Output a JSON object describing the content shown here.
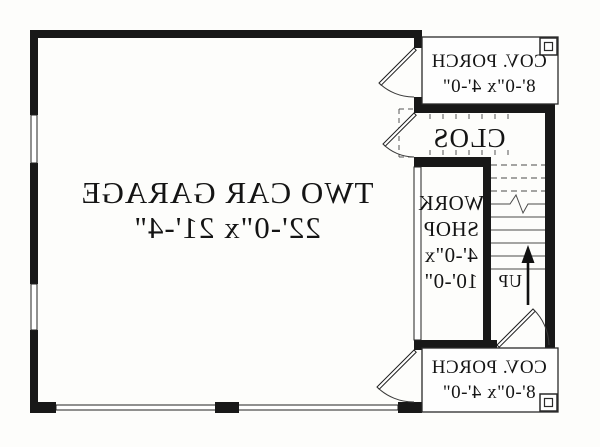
{
  "plan": {
    "garage": {
      "name": "TWO CAR GARAGE",
      "dims": "22'-0\"x 21'-4\""
    },
    "workshop": {
      "name_line1": "WORK",
      "name_line2": "SHOP",
      "dims_line1": "4'-0\"x",
      "dims_line2": "10'-0\""
    },
    "closet": {
      "name": "CLOS"
    },
    "porch_top": {
      "name": "COV. PORCH",
      "dims": "8'-0\"x 4'-0\""
    },
    "porch_bottom": {
      "name": "COV. PORCH",
      "dims": "8'-0\"x 4'-0\""
    },
    "stairs": {
      "direction_label": "UP"
    }
  },
  "colors": {
    "wall": "#181818",
    "line": "#2a2a2a",
    "background": "#fdfdfb"
  }
}
